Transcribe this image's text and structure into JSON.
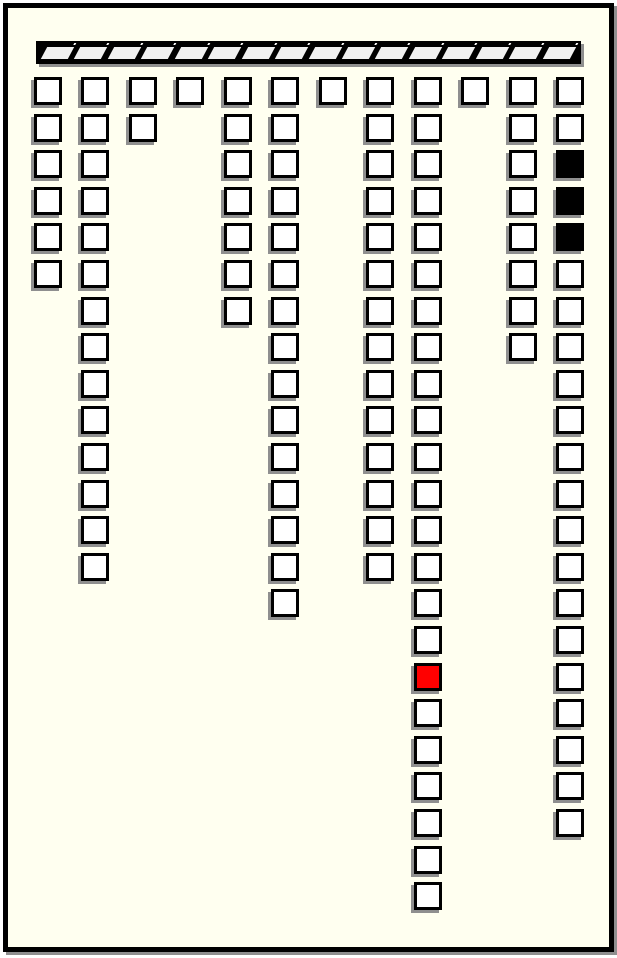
{
  "palette": {
    "canvas_background": "#ffffff",
    "board_background": "#fffff0",
    "frame_border": "#000000",
    "shadow": "#8f8f8f",
    "slot_border": "#000000",
    "slot_open_fill": "#ffffff",
    "slot_occupied_fill": "#000000",
    "slot_selected_fill": "#ff0000",
    "bar_fill": "#000000",
    "bar_segment_fill": "#f0f0f0"
  },
  "hatched_bar": {
    "segments": 16
  },
  "board": {
    "total_rows": 23,
    "total_columns": 12,
    "columns": [
      {
        "index": 1,
        "first_row": 1,
        "last_row": 6,
        "occupied_rows": [],
        "selected_rows": []
      },
      {
        "index": 2,
        "first_row": 1,
        "last_row": 14,
        "occupied_rows": [],
        "selected_rows": []
      },
      {
        "index": 3,
        "first_row": 1,
        "last_row": 2,
        "occupied_rows": [],
        "selected_rows": []
      },
      {
        "index": 4,
        "first_row": 1,
        "last_row": 1,
        "occupied_rows": [],
        "selected_rows": []
      },
      {
        "index": 5,
        "first_row": 1,
        "last_row": 7,
        "occupied_rows": [],
        "selected_rows": []
      },
      {
        "index": 6,
        "first_row": 1,
        "last_row": 15,
        "occupied_rows": [],
        "selected_rows": []
      },
      {
        "index": 7,
        "first_row": 1,
        "last_row": 1,
        "occupied_rows": [],
        "selected_rows": []
      },
      {
        "index": 8,
        "first_row": 1,
        "last_row": 14,
        "occupied_rows": [],
        "selected_rows": []
      },
      {
        "index": 9,
        "first_row": 1,
        "last_row": 23,
        "occupied_rows": [],
        "selected_rows": [
          17
        ]
      },
      {
        "index": 10,
        "first_row": 1,
        "last_row": 1,
        "occupied_rows": [],
        "selected_rows": []
      },
      {
        "index": 11,
        "first_row": 1,
        "last_row": 8,
        "occupied_rows": [],
        "selected_rows": []
      },
      {
        "index": 12,
        "first_row": 1,
        "last_row": 21,
        "occupied_rows": [
          3,
          4,
          5
        ],
        "selected_rows": []
      }
    ]
  }
}
